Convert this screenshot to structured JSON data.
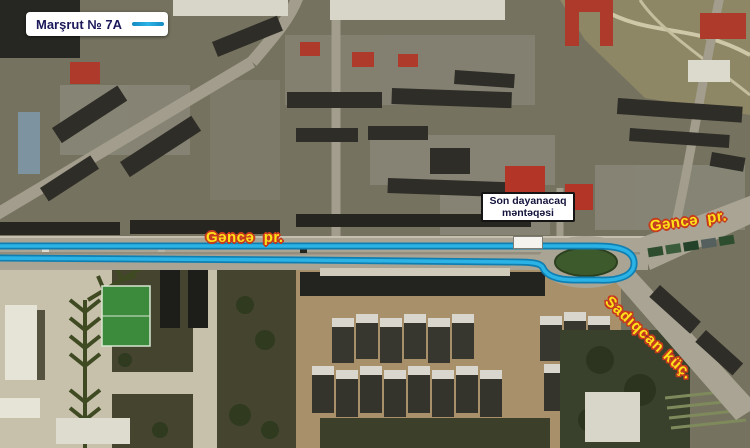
{
  "legend": {
    "route_label": "Marşrut № 7A",
    "route_color": "#2bb3e6"
  },
  "map": {
    "street_labels": {
      "avenue_left": "Gəncə  pr.",
      "avenue_right": "Gəncə  pr.",
      "side_street": "Sadıqcan küç."
    },
    "terminal_stop": {
      "line1": "Son dayanacaq",
      "line2": "məntəqəsi"
    },
    "colors": {
      "route_fill": "#2bb3e6",
      "route_edge": "#0f7fb2",
      "street_label_text": "#ffe11a",
      "street_label_outline": "#c63b1e",
      "legend_text": "#1c1a5a"
    }
  }
}
